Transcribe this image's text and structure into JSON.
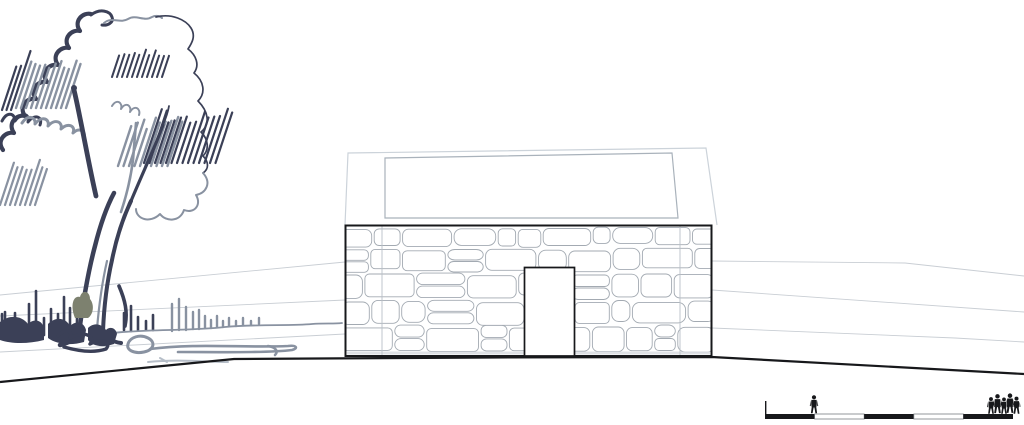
{
  "scene": {
    "kind": "architectural-elevation-sketch",
    "elements": [
      "tree-sketch",
      "horizon-lines",
      "roof-outline",
      "stone-wall",
      "door-opening",
      "ground-line",
      "scale-bar",
      "human-figures"
    ]
  },
  "labels": {
    "tree": "hand-drawn tree sketch",
    "building": "stone building elevation",
    "roof": "roof outline",
    "wall": "stone masonry wall",
    "door": "door opening",
    "ground": "ground line",
    "horizon": "perspective horizon lines",
    "scalebar": "graphic scale bar",
    "figures": "human scale figures"
  },
  "colors": {
    "ink_dark": "#3b4057",
    "ink_mid": "#8992a1",
    "ink_pale": "#b6bec8",
    "olive": "#7d816f",
    "line_black": "#17181b",
    "stone_outline": "#a3aab2",
    "roof_outer": "#ccd3da",
    "roof_inner": "#a9b2bb",
    "fold_line": "#b9c0c7",
    "faint": "#c9ced4",
    "white": "#ffffff"
  },
  "scale_bar": {
    "segments": [
      "black",
      "white",
      "black",
      "white",
      "black"
    ],
    "segment_count": 5
  },
  "figures": {
    "single_count": 1,
    "group_count": 5
  }
}
